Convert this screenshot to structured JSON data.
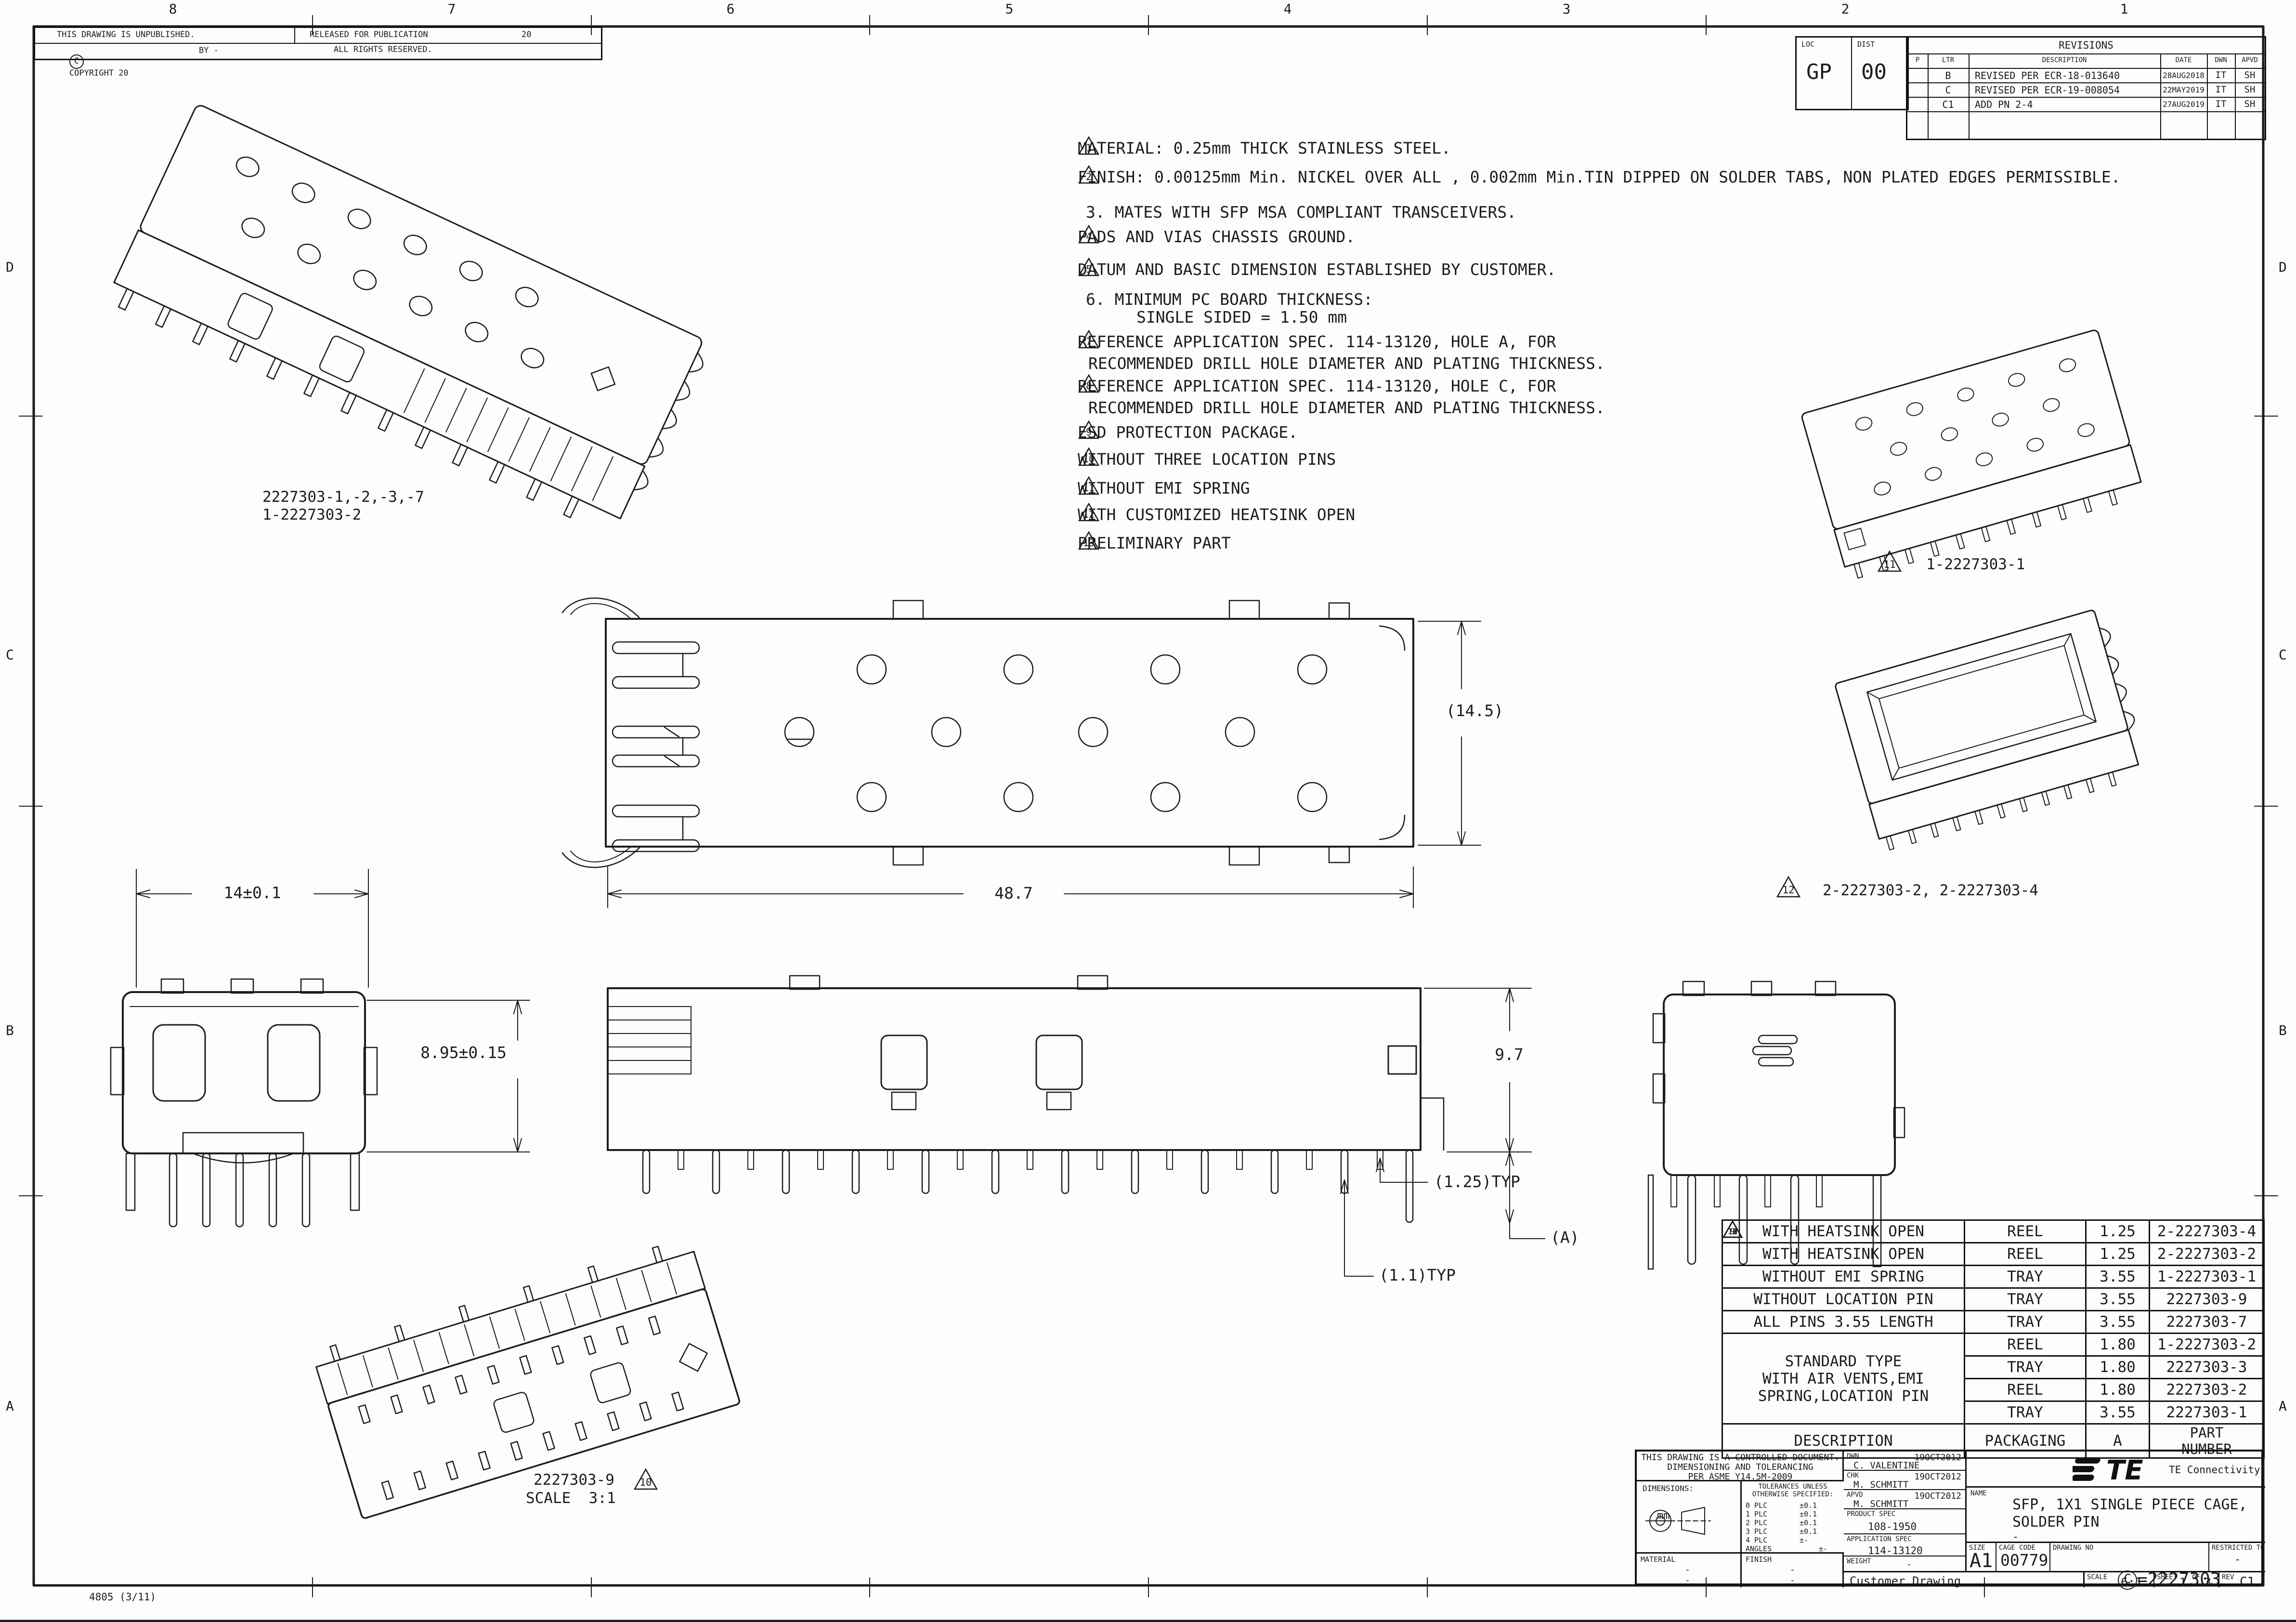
{
  "sheet": {
    "zones_top": [
      "8",
      "7",
      "6",
      "5",
      "4",
      "3",
      "2",
      "1"
    ],
    "zones_left": [
      "D",
      "C",
      "B",
      "A"
    ],
    "zones_right": [
      "D",
      "C",
      "B",
      "A"
    ],
    "stamp": "4805 (3/11)"
  },
  "header": {
    "unpublished": "THIS DRAWING IS UNPUBLISHED.",
    "released_for_publication": "RELEASED FOR PUBLICATION",
    "released_year": "20",
    "copyright_symbol": "C",
    "copyright": "COPYRIGHT 20",
    "by": "BY -",
    "all_rights": "ALL RIGHTS RESERVED."
  },
  "loc_box": {
    "loc_label": "LOC",
    "loc": "GP",
    "dist_label": "DIST",
    "dist": "00"
  },
  "revisions": {
    "title": "REVISIONS",
    "col_p": "P",
    "col_ltr": "LTR",
    "col_desc": "DESCRIPTION",
    "col_date": "DATE",
    "col_dwn": "DWN",
    "col_apvd": "APVD",
    "rows": [
      {
        "ltr": "B",
        "desc": "REVISED PER ECR-18-013640",
        "date": "28AUG2018",
        "dwn": "IT",
        "apvd": "SH"
      },
      {
        "ltr": "C",
        "desc": "REVISED PER ECR-19-008054",
        "date": "22MAY2019",
        "dwn": "IT",
        "apvd": "SH"
      },
      {
        "ltr": "C1",
        "desc": "ADD PN 2-4",
        "date": "27AUG2019",
        "dwn": "IT",
        "apvd": "SH"
      }
    ]
  },
  "notes": {
    "n1_flag": "1",
    "n1": "MATERIAL: 0.25mm THICK STAINLESS STEEL.",
    "n2_flag": "2",
    "n2": "FINISH: 0.00125mm Min. NICKEL OVER ALL , 0.002mm Min.TIN DIPPED ON SOLDER TABS, NON PLATED EDGES PERMISSIBLE.",
    "n3": "3. MATES WITH SFP MSA COMPLIANT TRANSCEIVERS.",
    "n4_flag": "4",
    "n4": "PADS AND VIAS CHASSIS GROUND.",
    "n5_flag": "5",
    "n5": "DATUM AND BASIC DIMENSION ESTABLISHED BY CUSTOMER.",
    "n6a": "6. MINIMUM PC BOARD THICKNESS:",
    "n6b": "SINGLE SIDED = 1.50 mm",
    "n7_flag": "7",
    "n7a": "REFERENCE APPLICATION SPEC. 114-13120, HOLE A, FOR",
    "n7b": "RECOMMENDED DRILL HOLE DIAMETER AND PLATING THICKNESS.",
    "n8_flag": "8",
    "n8a": "REFERENCE APPLICATION SPEC. 114-13120, HOLE C, FOR",
    "n8b": "RECOMMENDED DRILL HOLE DIAMETER AND PLATING THICKNESS.",
    "n9_flag": "9",
    "n9": "ESD PROTECTION PACKAGE.",
    "n10_flag": "10",
    "n10": "WITHOUT THREE LOCATION PINS",
    "n11_flag": "11",
    "n11": "WITHOUT EMI SPRING",
    "n12_flag": "12",
    "n12": "WITH CUSTOMIZED HEATSINK OPEN",
    "n13_flag": "13",
    "n13": "PRELIMINARY PART"
  },
  "view_labels": {
    "main_iso_line1": "2227303-1,-2,-3,-7",
    "main_iso_line2": "1-2227303-2",
    "top_right_flag": "11",
    "top_right": "1-2227303-1",
    "mid_right_flag": "12",
    "mid_right": "2-2227303-2, 2-2227303-4",
    "bottom_left_pn": "2227303-9",
    "bottom_left_scale": "SCALE  3:1",
    "bottom_left_flag": "10"
  },
  "dimensions": {
    "width": "14±0.1",
    "height": "8.95±0.15",
    "length": "48.7",
    "depth": "(14.5)",
    "side_height": "9.7",
    "pin_pitch": "(1.25)TYP",
    "pin_dia": "(1.1)TYP",
    "pin_len": "(A)"
  },
  "te_marking": "TE",
  "parts_table": {
    "rows": [
      {
        "desc": "WITH HEATSINK OPEN",
        "flag": "12",
        "pkg": "REEL",
        "a": "1.25",
        "pn": "2-2227303-4"
      },
      {
        "desc": "WITH HEATSINK OPEN",
        "flag": "12",
        "pkg": "REEL",
        "a": "1.25",
        "pn": "2-2227303-2"
      },
      {
        "desc": "WITHOUT EMI SPRING",
        "flag": "11",
        "pkg": "TRAY",
        "a": "3.55",
        "pn": "1-2227303-1"
      },
      {
        "desc": "WITHOUT LOCATION PIN",
        "flag": "10",
        "pkg": "TRAY",
        "a": "3.55",
        "pn": "2227303-9"
      },
      {
        "desc": "ALL PINS 3.55 LENGTH",
        "flag": "13",
        "pkg": "TRAY",
        "a": "3.55",
        "pn": "2227303-7"
      },
      {
        "flag": "9",
        "pkg": "REEL",
        "a": "1.80",
        "pn": "1-2227303-2"
      },
      {
        "pkg": "TRAY",
        "a": "1.80",
        "pn": "2227303-3"
      },
      {
        "pkg": "REEL",
        "a": "1.80",
        "pn": "2227303-2"
      },
      {
        "pkg": "TRAY",
        "a": "3.55",
        "pn": "2227303-1"
      }
    ],
    "merged_desc_line1": "STANDARD TYPE",
    "merged_desc_line2": "WITH AIR VENTS,EMI",
    "merged_desc_line3": "SPRING,LOCATION PIN",
    "footer_desc": "DESCRIPTION",
    "footer_pkg": "PACKAGING",
    "footer_a": "A",
    "footer_pn_line1": "PART",
    "footer_pn_line2": "NUMBER"
  },
  "title_block": {
    "controlled1": "THIS DRAWING IS A CONTROLLED DOCUMENT.",
    "controlled2": "DIMENSIONING AND TOLERANCING",
    "controlled3": "PER ASME Y14.5M-2009",
    "dimensions_label": "DIMENSIONS:",
    "units": "mm",
    "tol_header1": "TOLERANCES UNLESS",
    "tol_header2": "OTHERWISE SPECIFIED:",
    "tol": [
      {
        "k": "0 PLC",
        "v": "±0.1"
      },
      {
        "k": "1 PLC",
        "v": "±0.1"
      },
      {
        "k": "2 PLC",
        "v": "±0.1"
      },
      {
        "k": "3 PLC",
        "v": "±0.1"
      },
      {
        "k": "4 PLC",
        "v": "±-"
      },
      {
        "k": "ANGLES",
        "v": "±-"
      }
    ],
    "material_label": "MATERIAL",
    "material1": "-",
    "material2": "-",
    "finish_label": "FINISH",
    "finish1": "-",
    "finish2": "-",
    "dwn_label": "DWN",
    "dwn_name": "C. VALENTINE",
    "dwn_date": "19OCT2012",
    "chk_label": "CHK",
    "chk_name": "M. SCHMITT",
    "chk_date": "19OCT2012",
    "apvd_label": "APVD",
    "apvd_name": "M. SCHMITT",
    "apvd_date": "19OCT2012",
    "product_spec_label": "PRODUCT SPEC",
    "product_spec": "108-1950",
    "application_spec_label": "APPLICATION SPEC",
    "application_spec": "114-13120",
    "weight_label": "WEIGHT",
    "weight": "-",
    "logo_text": "TE",
    "brand": "TE Connectivity",
    "name_label": "NAME",
    "name1": "SFP, 1X1 SINGLE PIECE CAGE,",
    "name2": "SOLDER PIN",
    "name3": "-",
    "size_label": "SIZE",
    "size": "A1",
    "cage_label": "CAGE CODE",
    "cage": "00779",
    "dwg_label": "DRAWING NO",
    "dwg_prefix": "C",
    "dwg_sep": "=",
    "dwg": "2227303",
    "restricted_label": "RESTRICTED TO",
    "restricted": "-",
    "doc_type": "Customer Drawing",
    "scale_label": "SCALE",
    "scale": "6:1",
    "sheet_label": "SHEET",
    "sheet_no": "1",
    "of_label": "OF",
    "sheet_total": "3",
    "rev_label": "REV",
    "rev": "C1"
  }
}
